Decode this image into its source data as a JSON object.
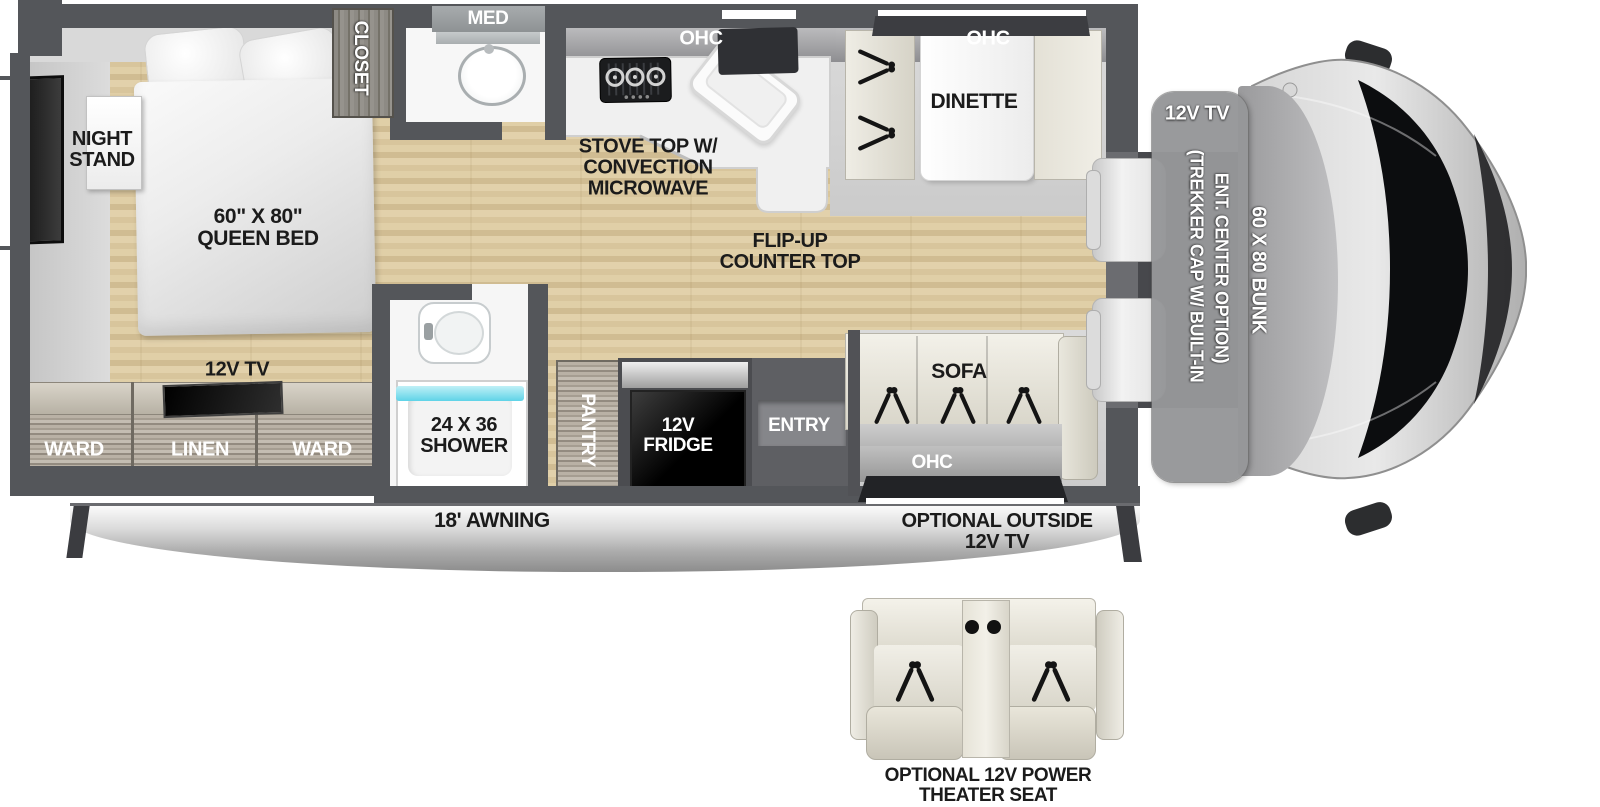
{
  "floorplan": {
    "bedroom": {
      "closet": "CLOSET",
      "night_stand": "NIGHT\nSTAND",
      "queen_bed": "60\" X 80\"\nQUEEN BED",
      "tv": "12V TV",
      "ward_left": "WARD",
      "linen": "LINEN",
      "ward_right": "WARD"
    },
    "bathroom": {
      "med": "MED",
      "shower": "24 X 36\nSHOWER"
    },
    "kitchen": {
      "ohc": "OHC",
      "stove": "STOVE TOP W/\nCONVECTION\nMICROWAVE",
      "flip_up_counter": "FLIP-UP\nCOUNTER TOP",
      "pantry": "PANTRY",
      "fridge": "12V\nFRIDGE",
      "entry": "ENTRY"
    },
    "dinette": {
      "ohc": "OHC",
      "label": "DINETTE"
    },
    "living": {
      "sofa": "SOFA",
      "ohc": "OHC"
    },
    "front": {
      "bunk_tv": "12V TV",
      "trekker_line1": "(TREKKER CAP W/ BUILT-IN",
      "trekker_line2": "ENT. CENTER OPTION)",
      "bunk": "60 X 80 BUNK"
    },
    "exterior": {
      "awning": "18' AWNING",
      "outside_tv": "OPTIONAL OUTSIDE\n12V TV"
    },
    "options": {
      "theater_seat": "OPTIONAL 12V POWER\nTHEATER SEAT"
    }
  },
  "colors": {
    "wall": "#54565a",
    "wood_floor": "#dccaa4",
    "slide_floor": "#d2d2d2",
    "cabinet": "#aaa298",
    "water_accent": "#6fd8ea",
    "label_dark": "#1b1b1b",
    "label_light": "#ffffff"
  }
}
